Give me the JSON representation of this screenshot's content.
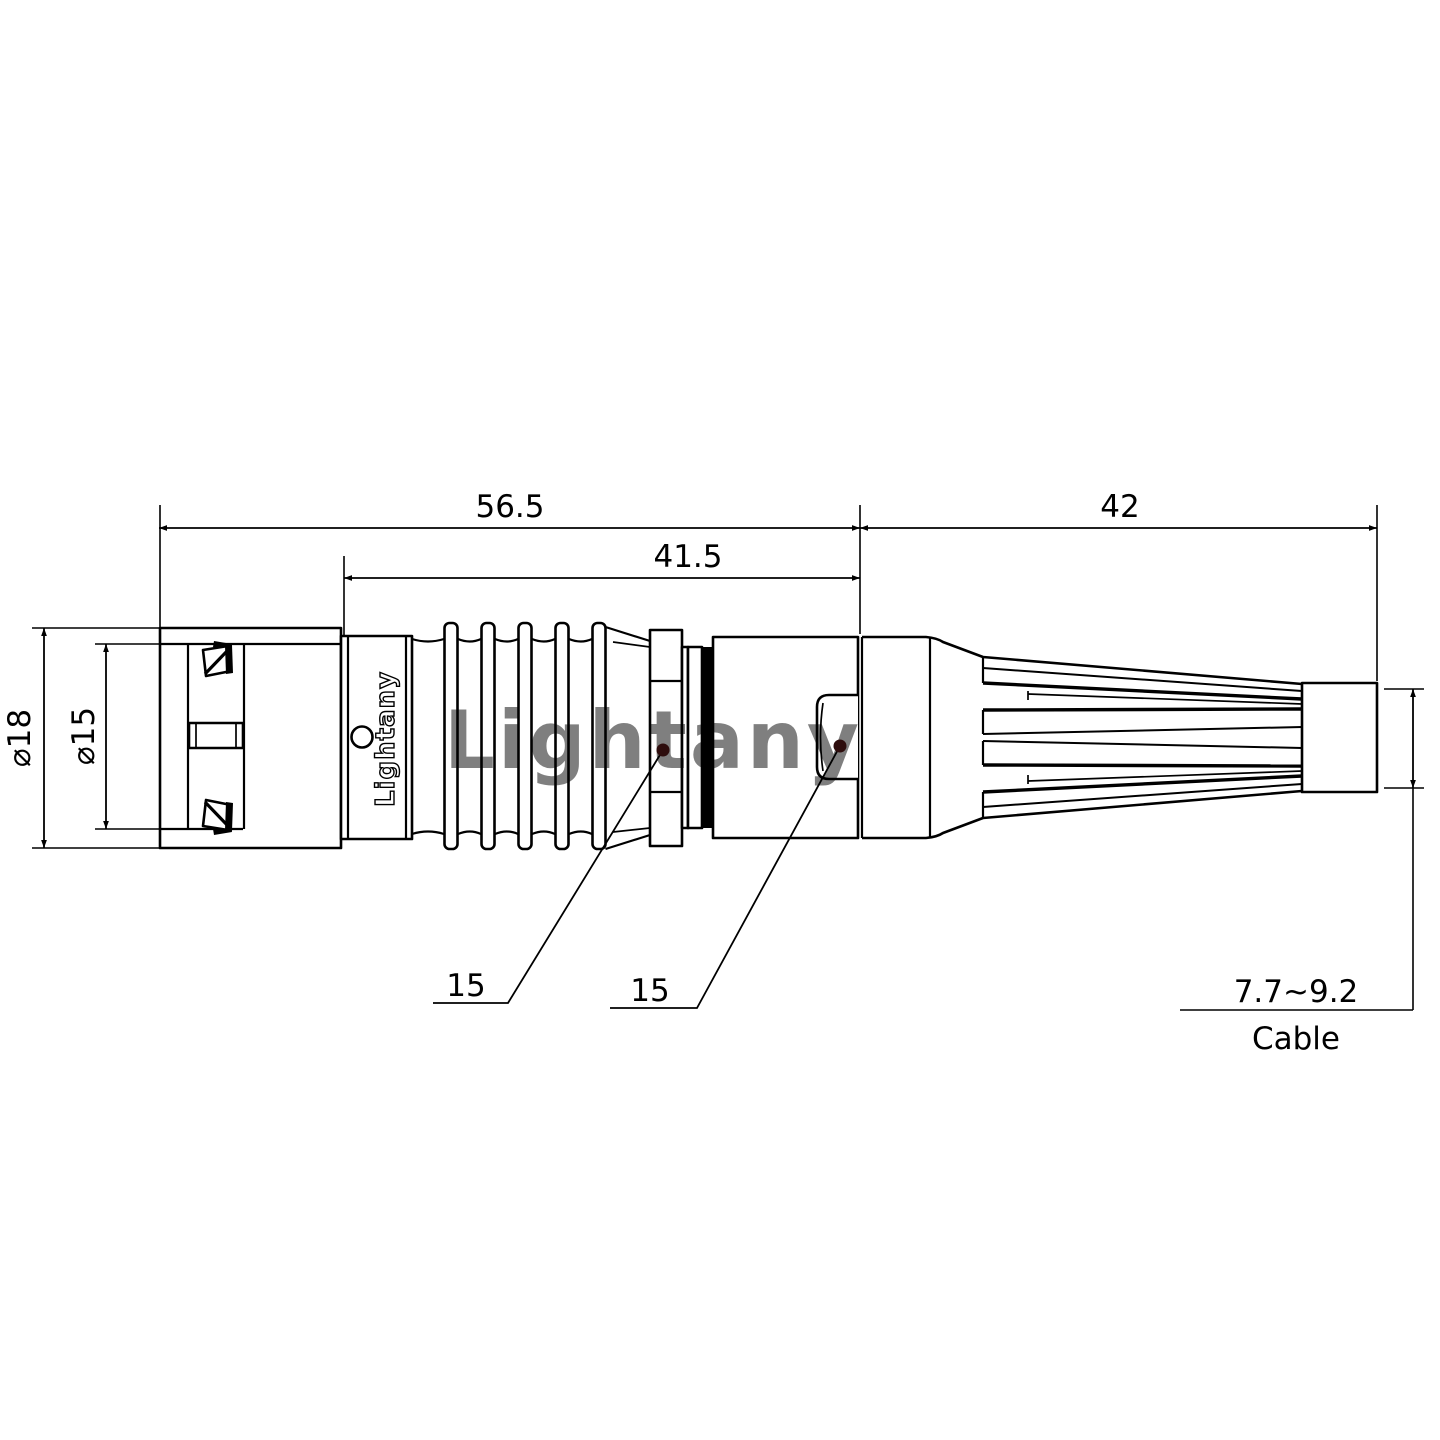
{
  "drawing": {
    "dimensions": {
      "overall_length": "56.5",
      "body_length": "41.5",
      "boot_length": "42",
      "outer_diameter": "⌀18",
      "inner_diameter": "⌀15",
      "nut_flat": "15",
      "shell_flat": "15",
      "cable_range": "7.7~9.2",
      "cable_label": "Cable"
    },
    "logo": "Lightany",
    "watermark": "Lightany",
    "colors": {
      "line": "#000000",
      "leader_dot": "#2e0d0d",
      "watermark": "#eba3a3"
    }
  }
}
